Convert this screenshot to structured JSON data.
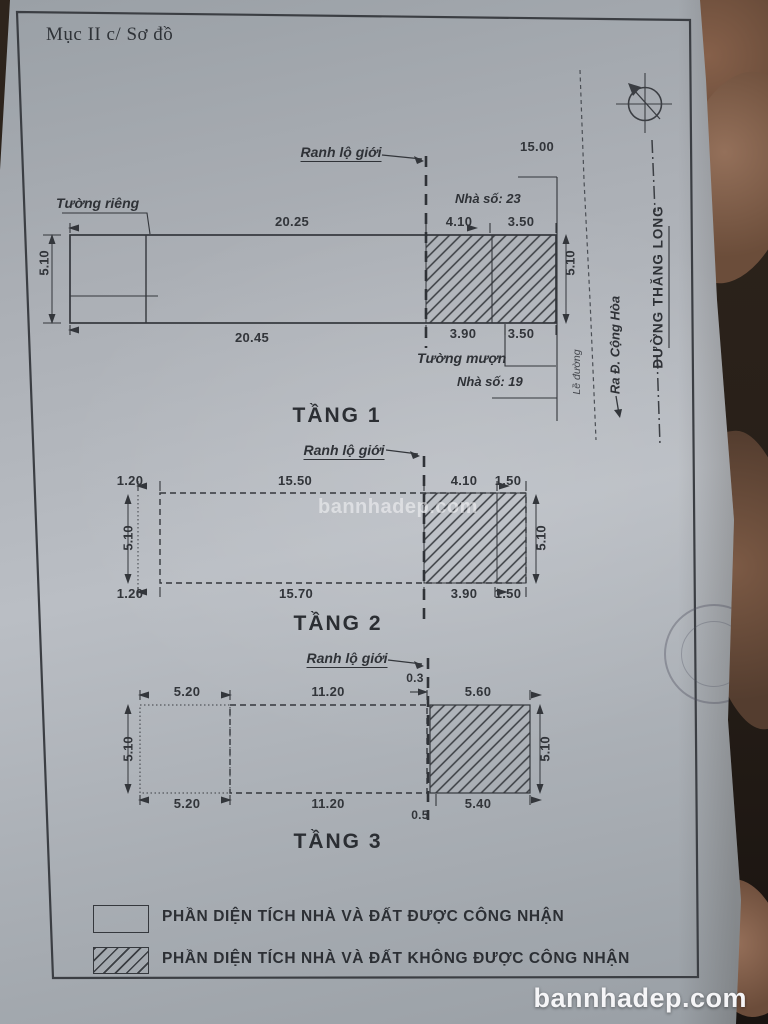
{
  "photo": {
    "center_watermark": "bannhadep.com",
    "bottom_watermark": "bannhadep.com"
  },
  "doc": {
    "header": "Mục II c/ Sơ đồ",
    "street": {
      "frontage": "15.00",
      "house_23": "Nhà số: 23",
      "house_19": "Nhà số: 19",
      "sidewalk": "Lề đường",
      "to_street": "Ra Đ. Cộng Hòa",
      "street_name": "ĐƯỜNG THĂNG LONG"
    },
    "floor1": {
      "title": "TẦNG 1",
      "boundary_label": "Ranh lộ giới",
      "private_wall": "Tường riêng",
      "borrowed_wall": "Tường mượn",
      "top": [
        "20.25",
        "4.10",
        "3.50"
      ],
      "bottom": [
        "20.45",
        "3.90",
        "3.50"
      ],
      "left": "5.10",
      "right": "5.10"
    },
    "floor2": {
      "title": "TẦNG 2",
      "boundary_label": "Ranh lộ giới",
      "top": [
        "1.20",
        "15.50",
        "4.10",
        "1.50"
      ],
      "bottom": [
        "1.20",
        "15.70",
        "3.90",
        "1.50"
      ],
      "left": "5.10",
      "right": "5.10"
    },
    "floor3": {
      "title": "TẦNG 3",
      "boundary_label": "Ranh lộ giới",
      "gap_top": "0.3",
      "gap_bottom": "0.5",
      "top": [
        "5.20",
        "11.20",
        "5.60"
      ],
      "bottom": [
        "5.20",
        "11.20",
        "5.40"
      ],
      "left": "5.10",
      "right": "5.10"
    },
    "legend": [
      {
        "label": "PHẦN DIỆN TÍCH  NHÀ VÀ ĐẤT ĐƯỢC CÔNG NHẬN"
      },
      {
        "label": "PHẦN DIỆN TÍCH  NHÀ VÀ ĐẤT KHÔNG ĐƯỢC CÔNG NHẬN"
      }
    ]
  },
  "colors": {
    "ink": "#32353a",
    "paper": "#aeb2b8",
    "background": "#271f18",
    "watermark": "#ffffff"
  }
}
